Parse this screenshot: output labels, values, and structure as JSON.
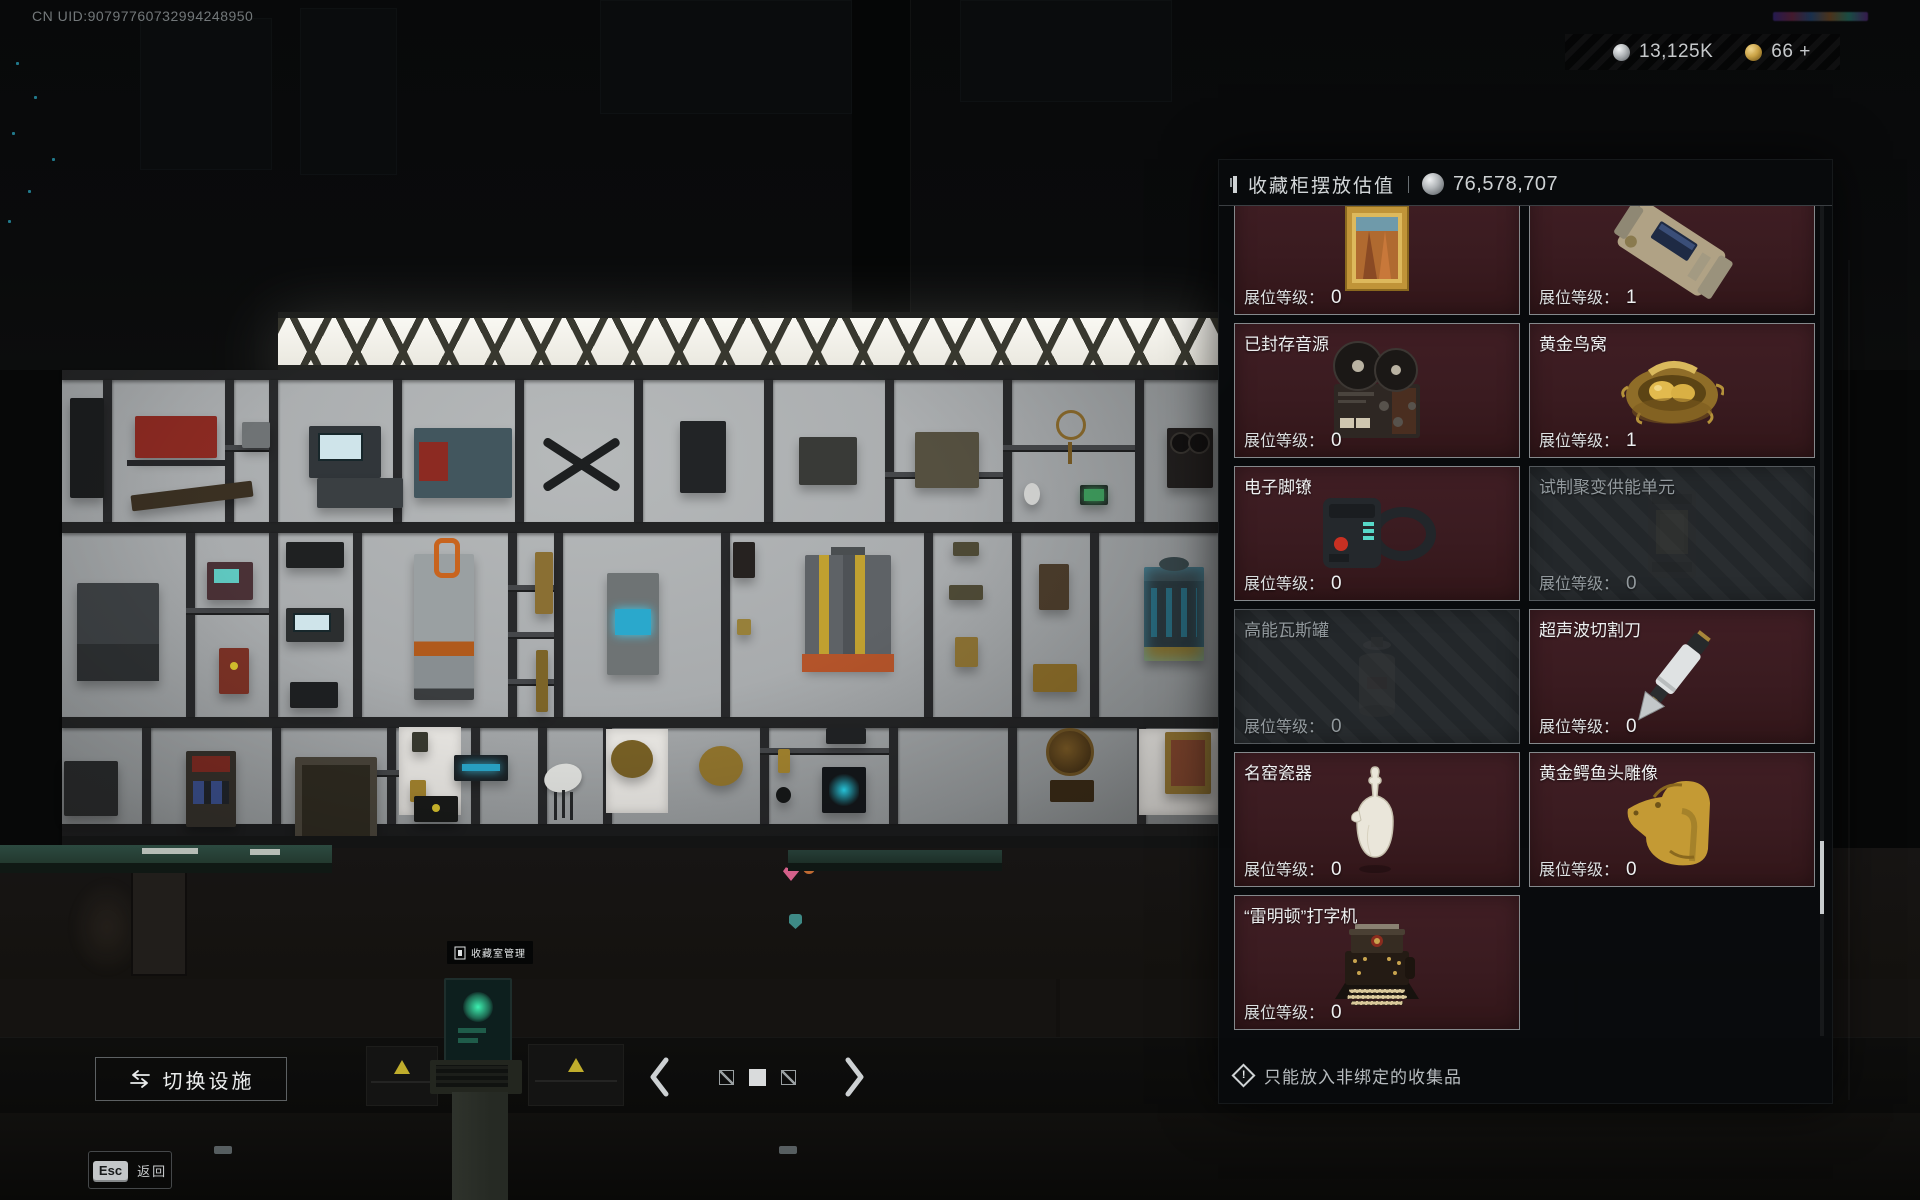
{
  "hud": {
    "uid": "CN UID:90797760732994248950",
    "currencies": [
      {
        "name": "silver",
        "icon": "silver-coin-icon",
        "value": "13,125K"
      },
      {
        "name": "gold",
        "icon": "gold-coin-icon",
        "value": "66 +"
      }
    ]
  },
  "panel": {
    "title": "收藏柜摆放估值",
    "value_icon": "silver-coin-icon",
    "value": "76,578,707",
    "level_label": "展位等级：",
    "footer_note": "只能放入非绑定的收集品",
    "items": [
      {
        "name": "",
        "level": "0",
        "state": "normal",
        "image": "framed-painting"
      },
      {
        "name": "",
        "level": "1",
        "state": "normal",
        "image": "military-transmitter"
      },
      {
        "name": "已封存音源",
        "level": "0",
        "state": "normal",
        "image": "reel-tape-recorder"
      },
      {
        "name": "黄金鸟窝",
        "level": "1",
        "state": "normal",
        "image": "golden-bird-nest"
      },
      {
        "name": "电子脚镣",
        "level": "0",
        "state": "normal",
        "image": "electronic-ankle-monitor"
      },
      {
        "name": "试制聚变供能单元",
        "level": "0",
        "state": "disabled",
        "image": "fusion-power-unit"
      },
      {
        "name": "高能瓦斯罐",
        "level": "0",
        "state": "disabled",
        "image": "gas-canister"
      },
      {
        "name": "超声波切割刀",
        "level": "0",
        "state": "normal",
        "image": "ultrasonic-cutter"
      },
      {
        "name": "名窑瓷器",
        "level": "0",
        "state": "normal",
        "image": "porcelain-vase"
      },
      {
        "name": "黄金鳄鱼头雕像",
        "level": "0",
        "state": "normal",
        "image": "golden-crocodile-head"
      },
      {
        "name": "“雷明顿”打字机",
        "level": "0",
        "state": "normal",
        "image": "remington-typewriter"
      }
    ]
  },
  "scene": {
    "kiosk_label": "收藏室管理"
  },
  "bottom_bar": {
    "switch_facility_label": "切换设施",
    "page_indicator": {
      "count": 3,
      "active_index": 1
    }
  },
  "esc_hint": {
    "key": "Esc",
    "label": "返回"
  }
}
